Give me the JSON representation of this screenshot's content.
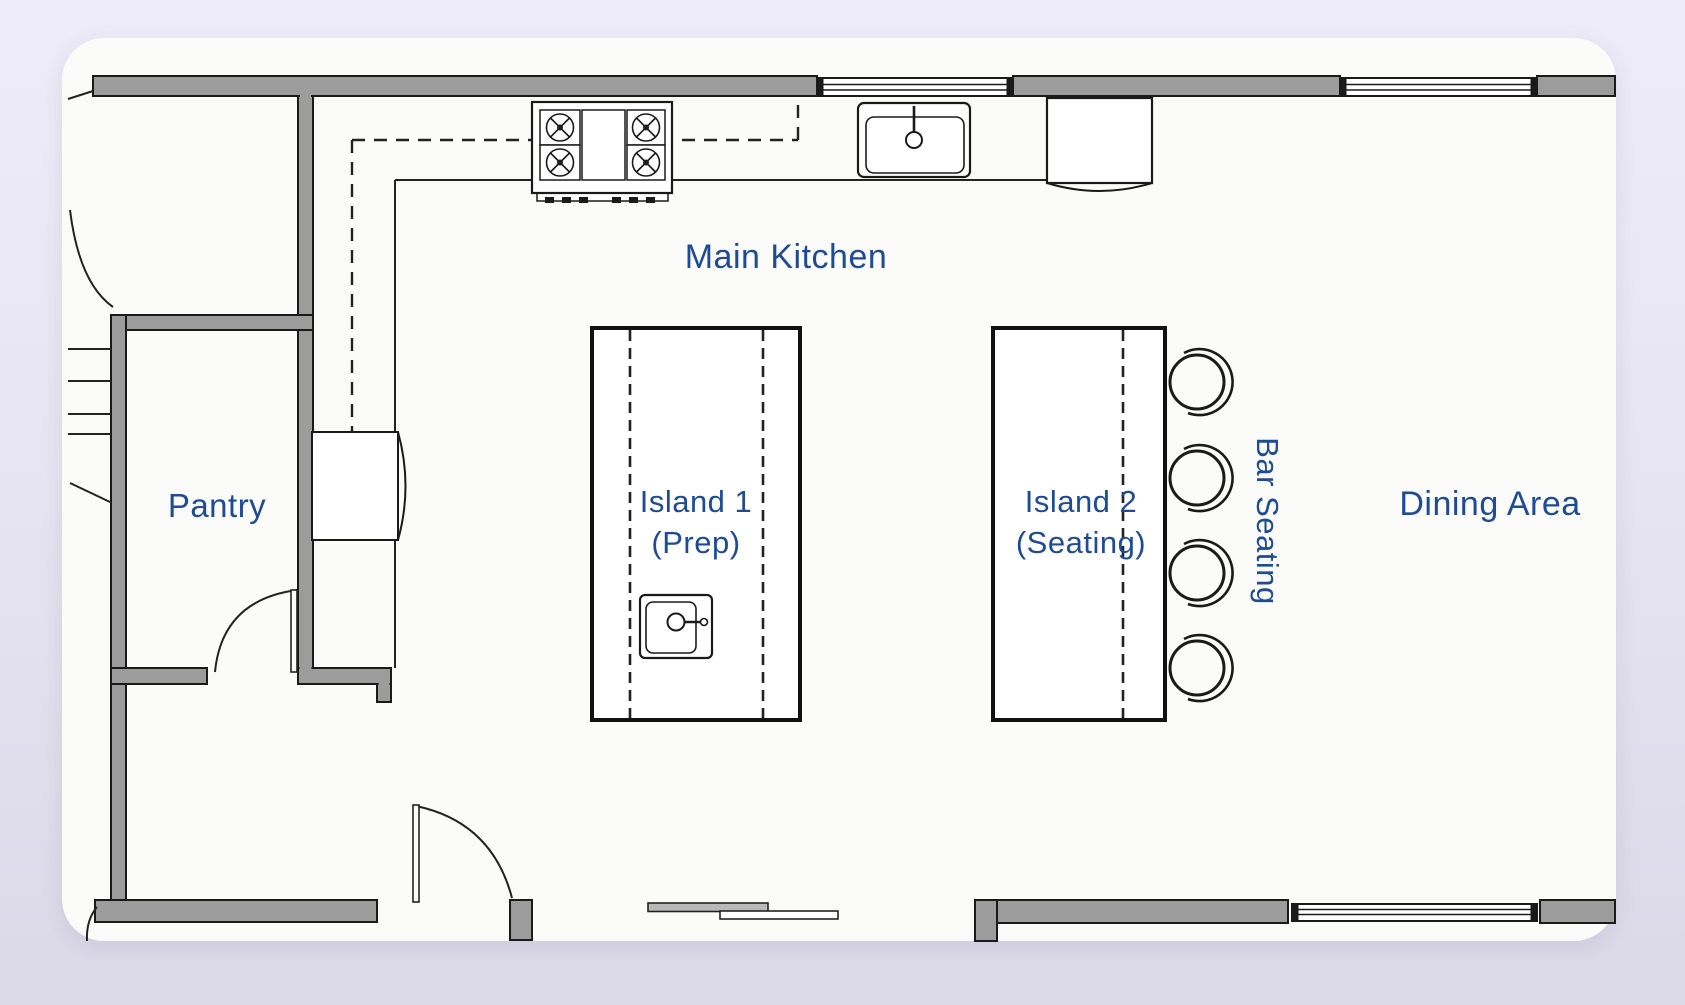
{
  "scene": {
    "type": "kitchen-floor-plan",
    "colors": {
      "background": "#e7e5f1",
      "floor_white": "#fbfbfa",
      "wall_fill": "#9c9c9c",
      "line_black": "#1a1a1a",
      "label_blue": "#1e4b93"
    }
  },
  "labels": {
    "main_kitchen": "Main Kitchen",
    "pantry": "Pantry",
    "island1": [
      "Island 1",
      "(Prep)"
    ],
    "island2": [
      "Island 2",
      "(Seating)"
    ],
    "bar_seating": "Bar Seating",
    "dining_area": "Dining Area"
  },
  "fixtures": [
    "range-cooktop-4-burner",
    "kitchen-sink-with-faucet",
    "refrigerator-top-wall",
    "refrigerator-side-wall",
    "prep-sink-island",
    "bar-stool-x4",
    "sliding-door",
    "window-top-left",
    "window-top-right",
    "window-bottom-right",
    "door-swing-foyer",
    "door-swing-pantry",
    "door-swing-bottom",
    "stairs",
    "work-triangle-dashed-path"
  ]
}
